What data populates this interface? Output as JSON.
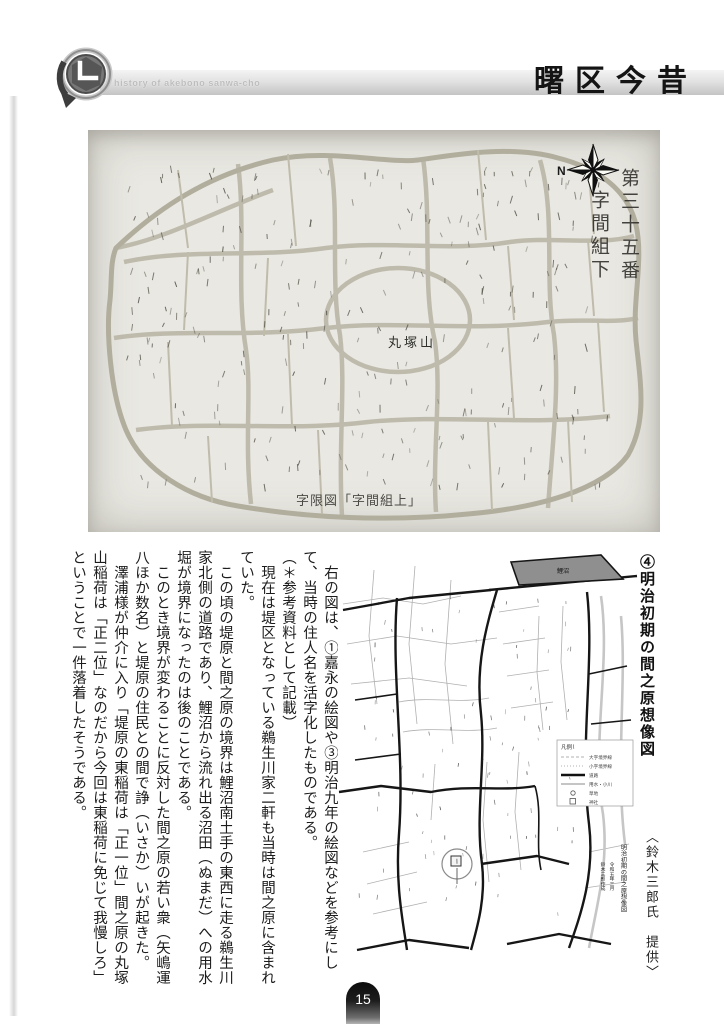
{
  "header": {
    "subtitle": "history of akebono sanwa-cho",
    "title": "曙区今昔"
  },
  "figure1": {
    "map_title_col1": "第三十五番",
    "map_title_col2": "字間組下",
    "hill_label": "丸塚山",
    "caption": "字限図「字間組上」",
    "compass_n": "N"
  },
  "article": {
    "paragraphs": [
      "　右の図は、①嘉永の絵図や③明治九年の絵図などを参考にして、当時の住人名を活字化したものである。",
      "（＊参考資料として記載）",
      "　現在は堤区となっている鵜生川家二軒も当時は間之原に含まれていた。",
      "　この頃の堤原と間之原の境界は鯉沼南土手の東西に走る鵜生川家北側の道路であり、鯉沼から流れ出る沼田（ぬまだ）への用水堀が境界になったのは後のことである。",
      "　このとき境界が変わることに反対した間之原の若い衆（矢嶋運八ほか数名）と堤原の住民との間で諍（いさか）いが起きた。",
      "　澤浦様が仲介に入り「堤原の東稲荷は「正一位」間之原の丸塚山稲荷は「正二位」なのだから今回は東稲荷に免じて我慢しろ」ということで一件落着したそうである。"
    ]
  },
  "figure2": {
    "title": "④明治初期の間之原想像図",
    "credit": "〈鈴木三郎氏　提供〉",
    "pond_label": "鯉沼",
    "inscription": {
      "line1": "明治初期の間之原想像図",
      "line2": "令和五年三月",
      "line3": "鈴木三郎作成"
    },
    "legend": {
      "title": "凡例",
      "items": [
        "大字境界線",
        "小字境界線",
        "道路",
        "用水・小川",
        "草地",
        "神社"
      ]
    }
  },
  "page": {
    "number": "15"
  },
  "colors": {
    "pond": "#8f8f8f",
    "band": "#d9d9d9"
  }
}
